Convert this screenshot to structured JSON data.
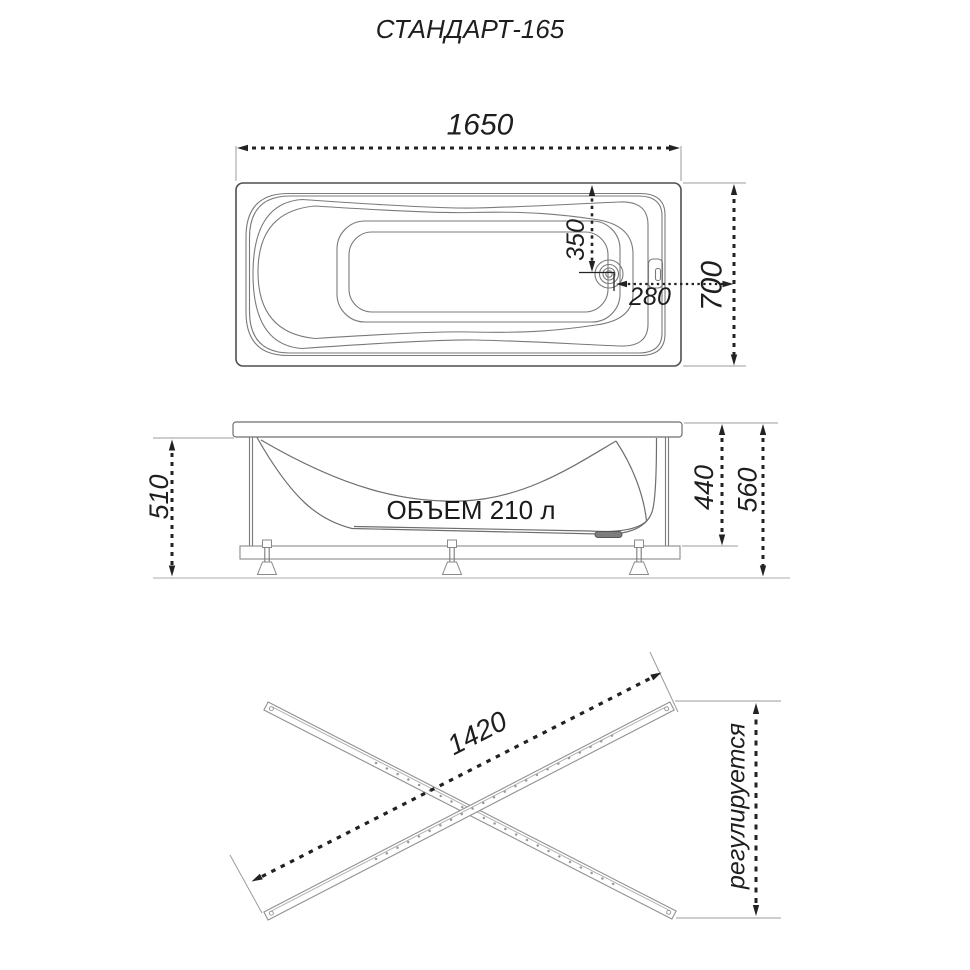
{
  "title": "СТАНДАРТ-165",
  "colors": {
    "ink": "#222222",
    "drawing_line": "#7a7a7a"
  },
  "top_view": {
    "length_mm": "1650",
    "width_mm": "700",
    "drain_offset_from_top_mm": "350",
    "drain_offset_from_end_mm": "280"
  },
  "side_view": {
    "skirt_height_mm": "510",
    "inner_depth_mm": "440",
    "total_height_mm": "560",
    "volume_label": "ОБЪЕМ 210 л"
  },
  "bottom_view": {
    "rail_length_mm": "1420",
    "adjustable_label": "регулируется"
  }
}
